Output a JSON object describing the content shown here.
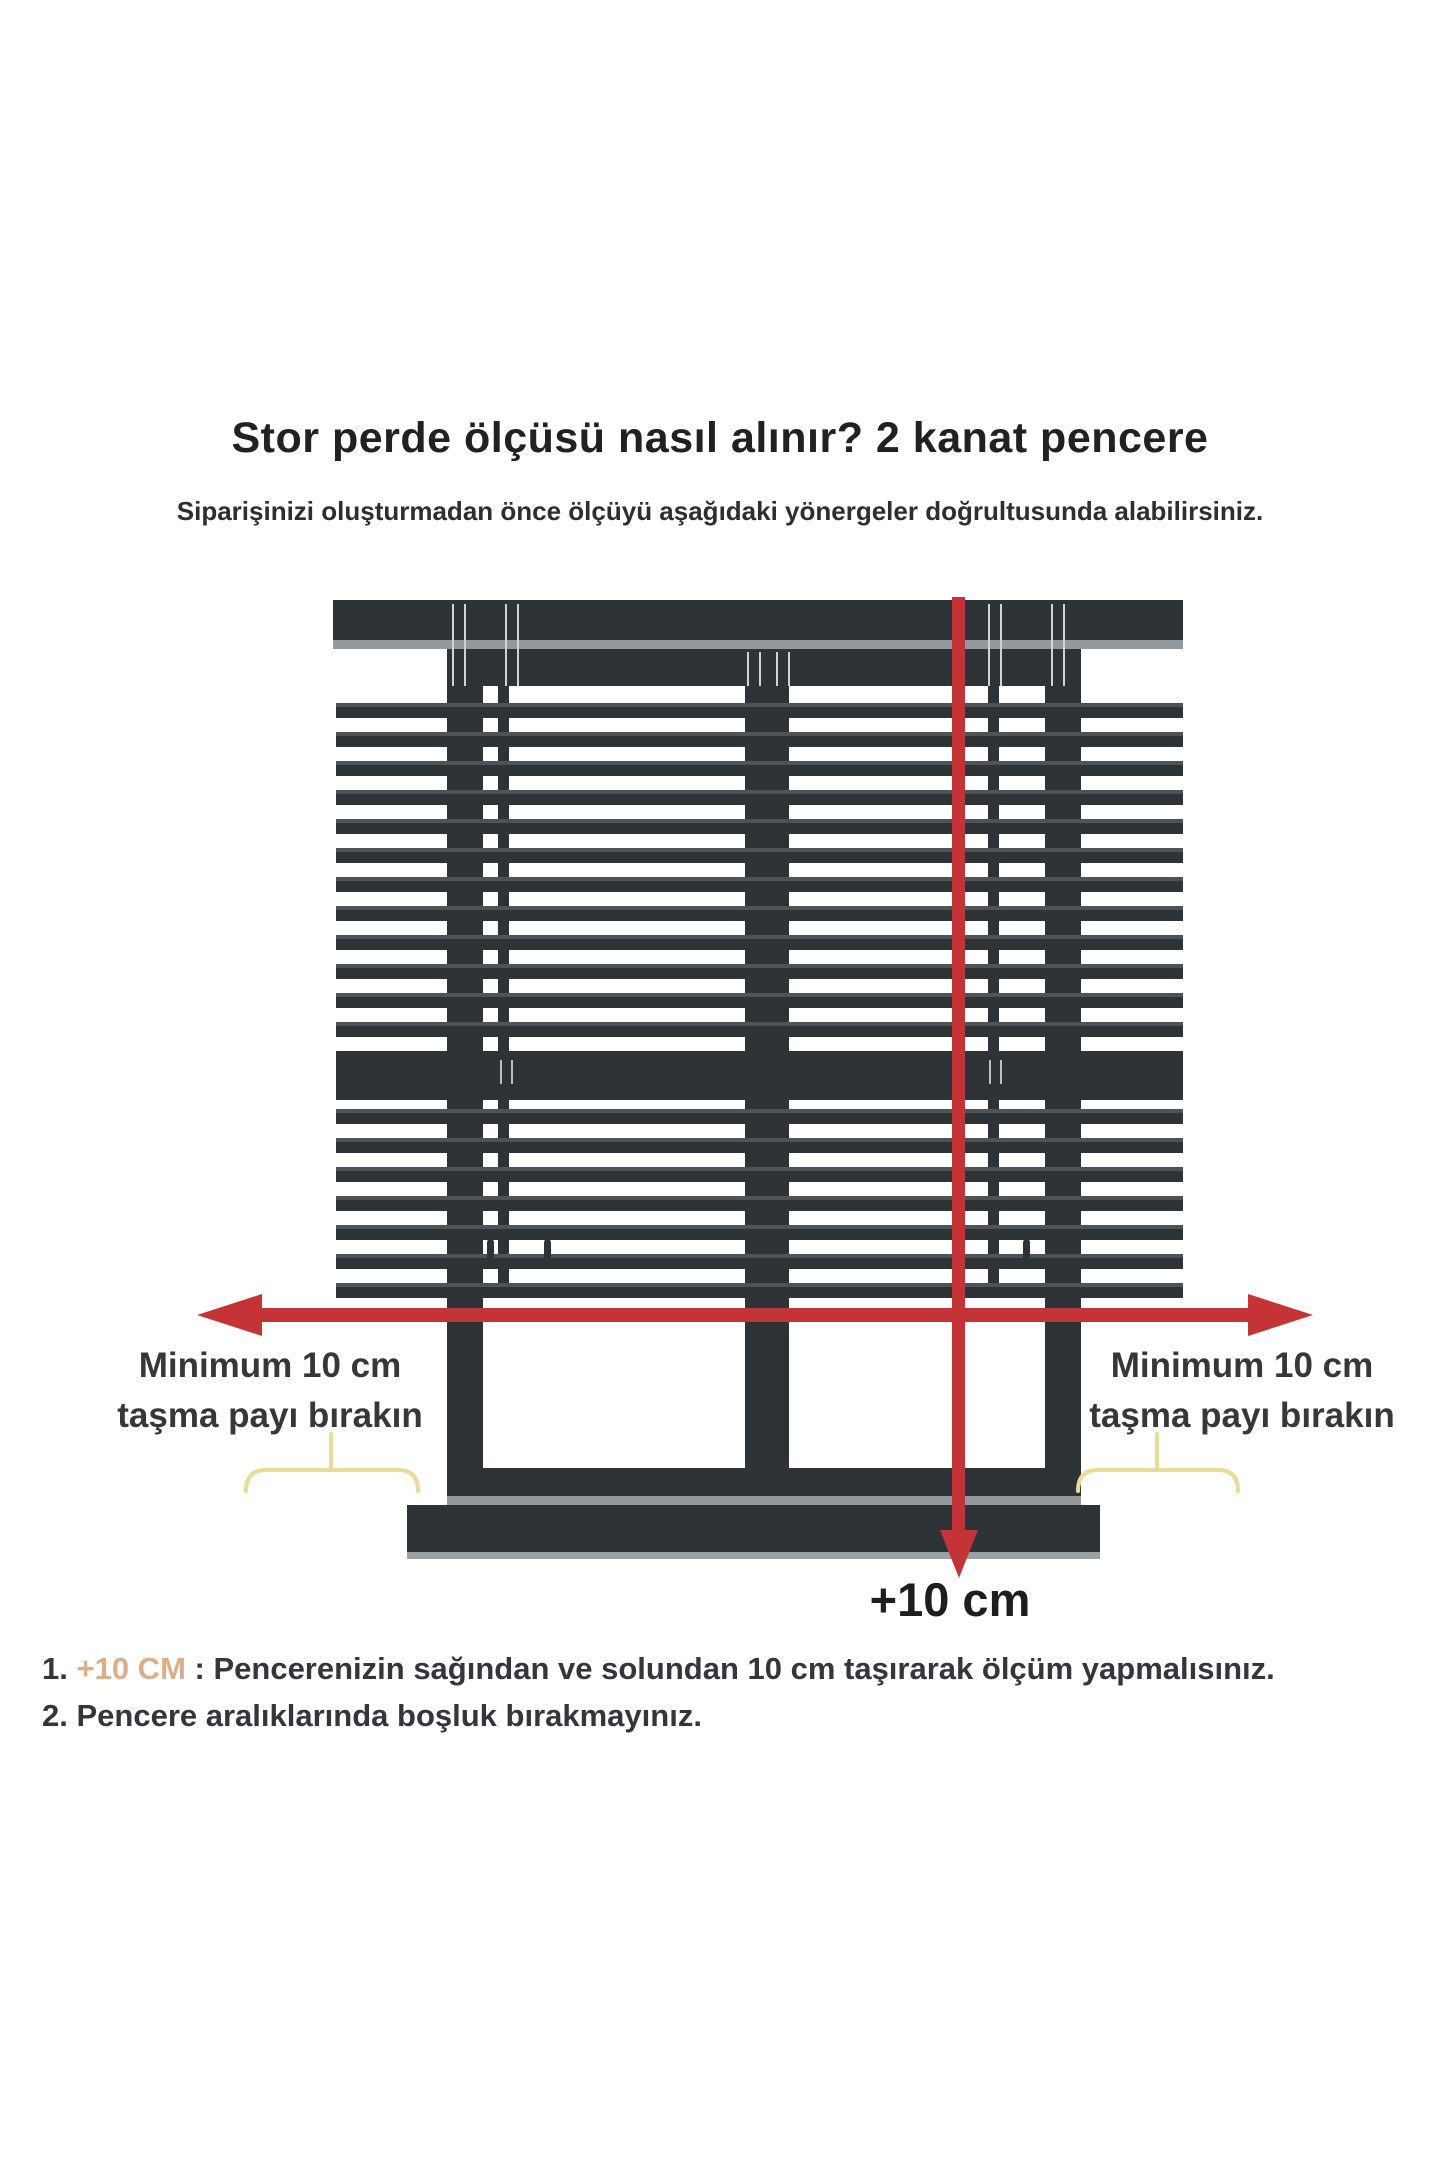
{
  "header": {
    "title": "Stor perde ölçüsü nasıl alınır? 2 kanat pencere",
    "subtitle": "Siparişinizi oluşturmadan önce ölçüyü aşağıdaki yönergeler doğrultusunda alabilirsiniz."
  },
  "diagram": {
    "left_label": {
      "line1": "Minimum 10 cm",
      "line2": "taşma payı bırakın"
    },
    "right_label": {
      "line1": "Minimum 10 cm",
      "line2": "taşma payı bırakın"
    },
    "bottom_measurement": "+10 cm"
  },
  "notes": [
    {
      "number": "1.",
      "highlight": "+10 CM",
      "separator": " : ",
      "text": "Pencerenizin sağından ve solundan 10 cm taşırarak ölçüm yapmalısınız."
    },
    {
      "number": "2.",
      "highlight": "",
      "separator": "",
      "text": "Pencere aralıklarında boşluk bırakmayınız."
    }
  ],
  "colors": {
    "frame_dark": "#2e3337",
    "slat_highlight": "#4d5357",
    "rail_light": "#93999d",
    "sill_edge_light": "#9aa0a3",
    "arrow_red": "#c43336",
    "bracket_yellow": "#e8dc96",
    "tape_line_light": "#cfd3d5",
    "text_dark": "#212121",
    "note_text": "#35353b",
    "note_highlight_tan": "#dcae88"
  }
}
